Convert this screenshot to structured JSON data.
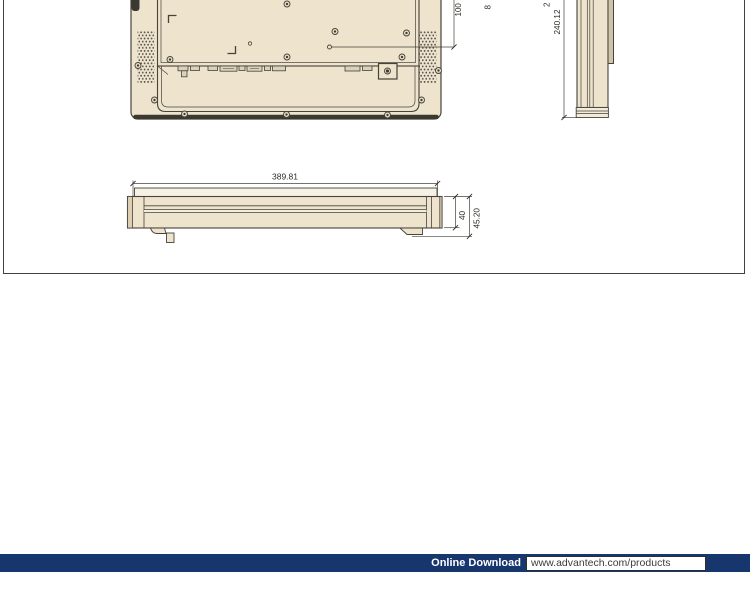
{
  "frame": {
    "border_color": "#404040"
  },
  "drawing": {
    "colors": {
      "case_fill": "#eee3cd",
      "lighter_fill": "#f6f1e4",
      "darker_fill": "#cfc3ac",
      "line": "#45433a",
      "dark_edge": "#3a382f"
    }
  },
  "dims": {
    "vesa_spacing": "100",
    "side_height": "240.12",
    "front_width": "389.81",
    "depth_body": "40",
    "depth_total": "45.20",
    "fragment_a": "8",
    "fragment_b": "2"
  },
  "footer": {
    "label": "Online Download",
    "url": "www.advantech.com/products",
    "bar_color": "#17366d"
  }
}
